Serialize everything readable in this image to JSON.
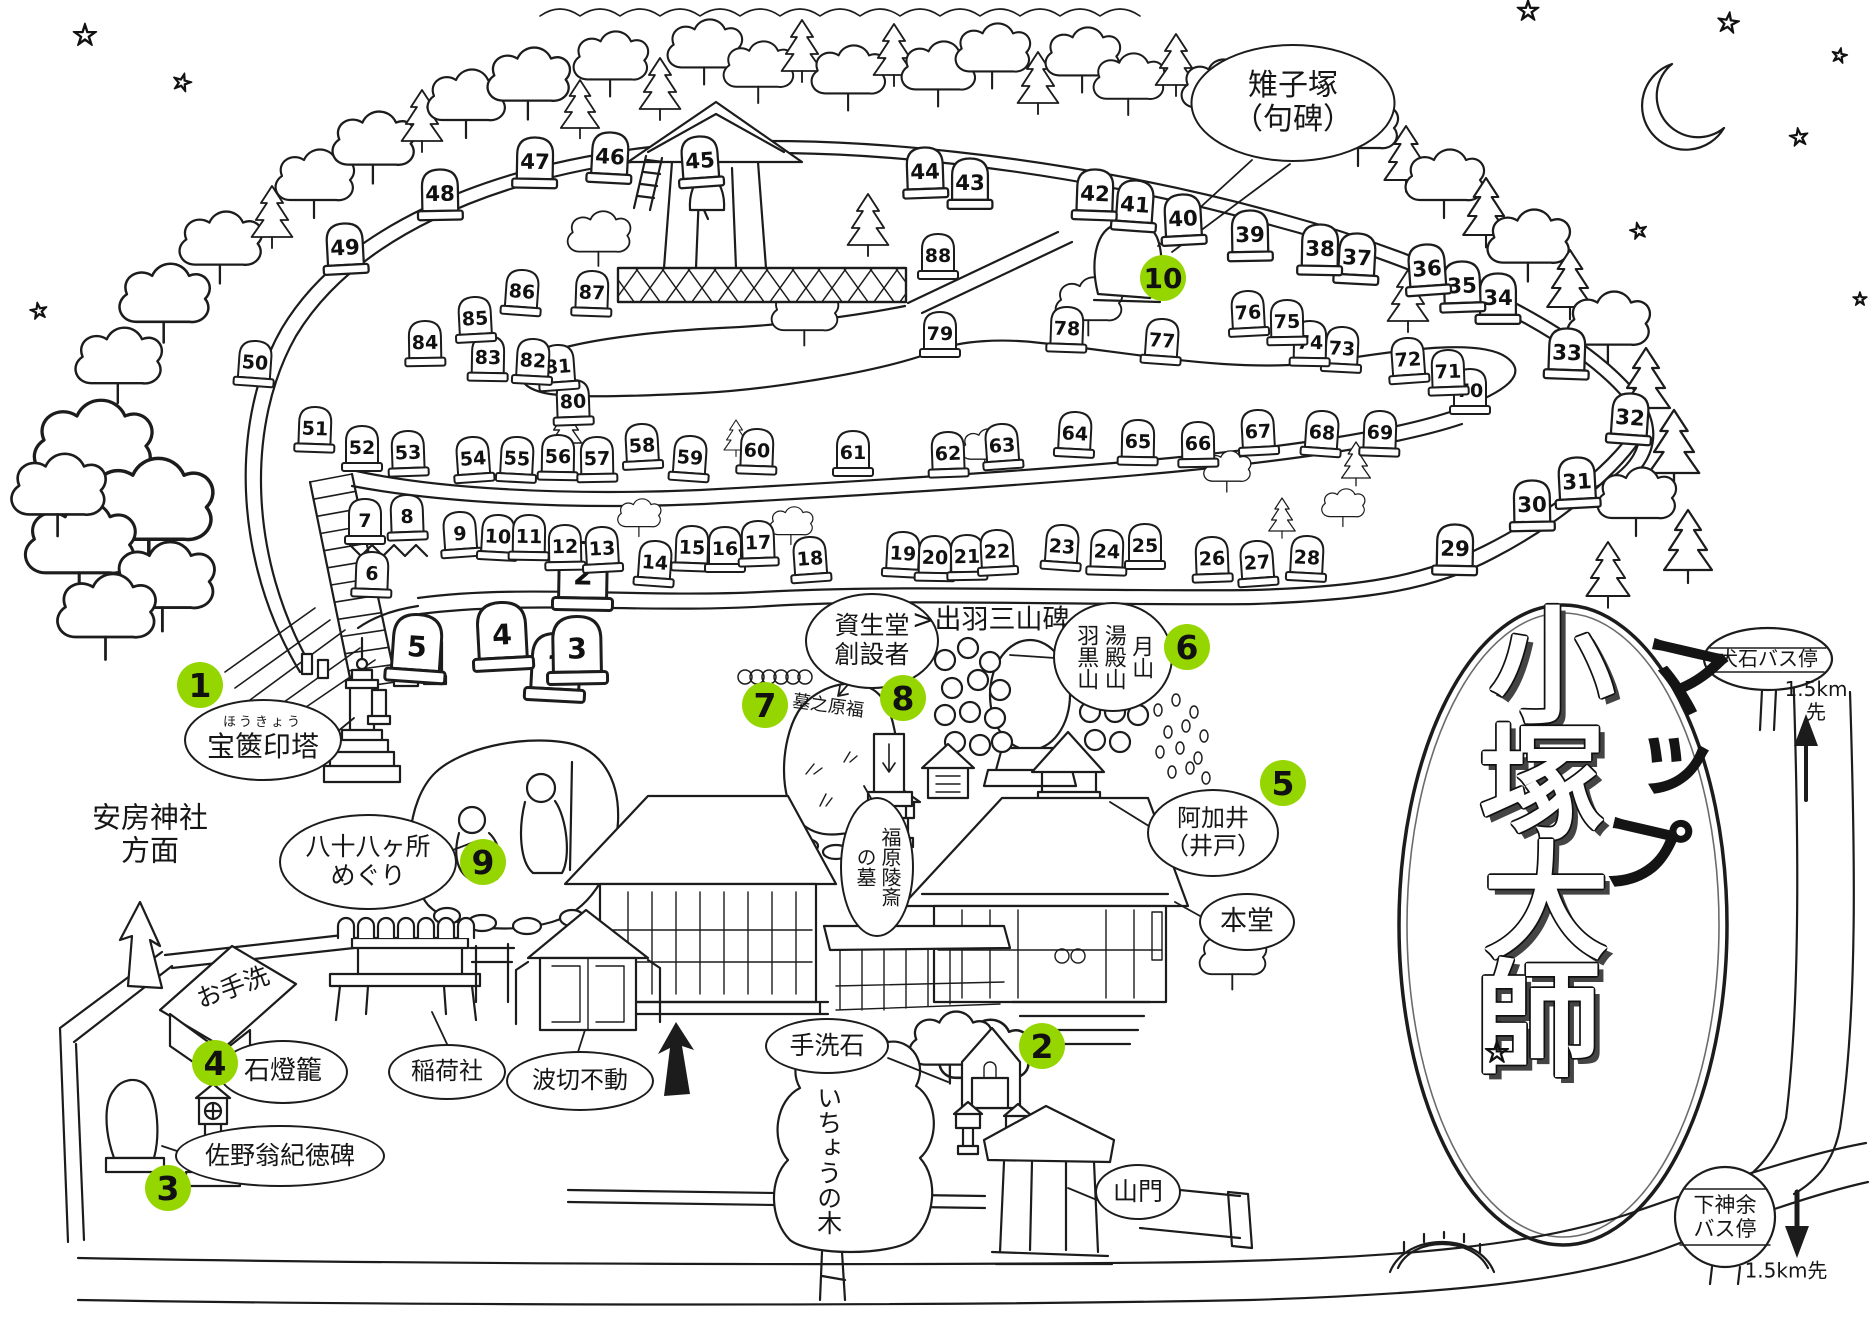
{
  "canvas": {
    "bg": "#ffffff",
    "ink": "#1c1c1c",
    "marker_green": "#96d600"
  },
  "title": {
    "chars": [
      "小",
      "塚",
      "大",
      "師"
    ],
    "sub": "マップ",
    "star": "☆"
  },
  "decorations": {
    "star_glyph": "☆"
  },
  "markers": [
    {
      "n": "1",
      "x": 200,
      "y": 685
    },
    {
      "n": "2",
      "x": 1042,
      "y": 1046
    },
    {
      "n": "3",
      "x": 168,
      "y": 1188
    },
    {
      "n": "4",
      "x": 215,
      "y": 1063
    },
    {
      "n": "5",
      "x": 1283,
      "y": 783
    },
    {
      "n": "6",
      "x": 1187,
      "y": 647
    },
    {
      "n": "7",
      "x": 765,
      "y": 705
    },
    {
      "n": "8",
      "x": 903,
      "y": 698
    },
    {
      "n": "9",
      "x": 483,
      "y": 862
    },
    {
      "n": "10",
      "x": 1163,
      "y": 278
    }
  ],
  "bubbles": [
    {
      "id": "kijizuka",
      "text": "雉子塚\n（句碑）",
      "x": 1293,
      "y": 103,
      "w": 205,
      "h": 118,
      "shape": "ellipse",
      "fs": 30
    },
    {
      "id": "hokyointo",
      "ruby": "ほうきょう",
      "text": "宝篋印塔",
      "x": 263,
      "y": 740,
      "w": 158,
      "h": 82,
      "shape": "ellipse",
      "fs": 28
    },
    {
      "id": "awa-jinja",
      "text": "安房神社\n方面",
      "x": 150,
      "y": 835,
      "shape": "plain",
      "fs": 29
    },
    {
      "id": "hachijuhachi",
      "text": "八十八ヶ所\nめぐり",
      "x": 368,
      "y": 862,
      "w": 178,
      "h": 96,
      "shape": "ellipse",
      "fs": 25
    },
    {
      "id": "otearai",
      "text": "お手洗",
      "x": 233,
      "y": 988,
      "shape": "plain",
      "fs": 25,
      "rot": -20
    },
    {
      "id": "ishidoro",
      "text": "石燈籠",
      "x": 283,
      "y": 1072,
      "w": 130,
      "h": 64,
      "shape": "ellipse",
      "fs": 26
    },
    {
      "id": "sano",
      "text": "佐野翁紀徳碑",
      "x": 280,
      "y": 1156,
      "w": 210,
      "h": 62,
      "shape": "ellipse",
      "fs": 25
    },
    {
      "id": "inari",
      "text": "稲荷社",
      "x": 447,
      "y": 1072,
      "w": 118,
      "h": 56,
      "shape": "ellipse",
      "fs": 24
    },
    {
      "id": "namikiri",
      "text": "波切不動",
      "x": 580,
      "y": 1081,
      "w": 148,
      "h": 60,
      "shape": "ellipse",
      "fs": 24
    },
    {
      "id": "shiseido",
      "text": "資生堂\n創設者",
      "x": 872,
      "y": 641,
      "w": 134,
      "h": 96,
      "shape": "ellipse",
      "fs": 25
    },
    {
      "id": "dewa",
      "text": ">出羽三山碑<",
      "x": 1002,
      "y": 620,
      "shape": "plain",
      "fs": 27
    },
    {
      "id": "sanzan",
      "text": "月山\n湯殿山\n羽黒山",
      "x": 1113,
      "y": 657,
      "w": 120,
      "h": 110,
      "shape": "ellipse",
      "fs": 22,
      "vertical": true
    },
    {
      "id": "fukuhara-grave",
      "text": "福原陵斎\nの墓",
      "x": 877,
      "y": 867,
      "w": 74,
      "h": 140,
      "shape": "ellipse",
      "fs": 20,
      "vertical": true
    },
    {
      "id": "fukuhara-rock",
      "text": "墓之原福",
      "x": 828,
      "y": 707,
      "shape": "plain",
      "fs": 18,
      "rot": 8
    },
    {
      "id": "akai",
      "text": "阿加井\n（井戸）",
      "x": 1213,
      "y": 833,
      "w": 132,
      "h": 88,
      "shape": "ellipse",
      "fs": 24
    },
    {
      "id": "hondo",
      "text": "本堂",
      "x": 1247,
      "y": 922,
      "w": 96,
      "h": 58,
      "shape": "ellipse",
      "fs": 27
    },
    {
      "id": "tearaiishi",
      "text": "手洗石",
      "x": 827,
      "y": 1046,
      "w": 124,
      "h": 56,
      "shape": "ellipse",
      "fs": 25
    },
    {
      "id": "icho",
      "text": "いちょうの木",
      "x": 828,
      "y": 1160,
      "shape": "plain",
      "fs": 25,
      "vertical": true
    },
    {
      "id": "sanmon",
      "text": "山門",
      "x": 1138,
      "y": 1192,
      "w": 86,
      "h": 56,
      "shape": "ellipse",
      "fs": 25
    },
    {
      "id": "inuishi-bus",
      "text": "犬石バス停",
      "x": 1768,
      "y": 659,
      "shape": "sign",
      "fs": 20
    },
    {
      "id": "inuishi-km",
      "text": "1.5km先",
      "x": 1816,
      "y": 701,
      "shape": "plain",
      "fs": 20
    },
    {
      "id": "shimokanamari-bus",
      "text": "下神余\nバス停",
      "x": 1725,
      "y": 1217,
      "shape": "sign",
      "fs": 21
    },
    {
      "id": "shimokanamari-km",
      "text": "1.5km先",
      "x": 1786,
      "y": 1271,
      "shape": "plain",
      "fs": 20
    }
  ],
  "stones": [
    {
      "n": 1,
      "x": 556,
      "y": 665
    },
    {
      "n": 2,
      "x": 583,
      "y": 574
    },
    {
      "n": 3,
      "x": 577,
      "y": 648
    },
    {
      "n": 4,
      "x": 502,
      "y": 634
    },
    {
      "n": 5,
      "x": 417,
      "y": 646
    },
    {
      "n": 6,
      "x": 372,
      "y": 573
    },
    {
      "n": 7,
      "x": 365,
      "y": 520
    },
    {
      "n": 8,
      "x": 407,
      "y": 516
    },
    {
      "n": 9,
      "x": 460,
      "y": 533
    },
    {
      "n": 10,
      "x": 498,
      "y": 536
    },
    {
      "n": 11,
      "x": 529,
      "y": 536
    },
    {
      "n": 12,
      "x": 565,
      "y": 546
    },
    {
      "n": 13,
      "x": 602,
      "y": 548
    },
    {
      "n": 14,
      "x": 655,
      "y": 562
    },
    {
      "n": 15,
      "x": 692,
      "y": 547
    },
    {
      "n": 16,
      "x": 725,
      "y": 548
    },
    {
      "n": 17,
      "x": 758,
      "y": 542
    },
    {
      "n": 18,
      "x": 810,
      "y": 558
    },
    {
      "n": 19,
      "x": 903,
      "y": 553
    },
    {
      "n": 20,
      "x": 935,
      "y": 557
    },
    {
      "n": 21,
      "x": 967,
      "y": 556
    },
    {
      "n": 22,
      "x": 997,
      "y": 551
    },
    {
      "n": 23,
      "x": 1062,
      "y": 546
    },
    {
      "n": 24,
      "x": 1107,
      "y": 551
    },
    {
      "n": 25,
      "x": 1145,
      "y": 545
    },
    {
      "n": 26,
      "x": 1212,
      "y": 558
    },
    {
      "n": 27,
      "x": 1257,
      "y": 562
    },
    {
      "n": 28,
      "x": 1307,
      "y": 557
    },
    {
      "n": 29,
      "x": 1455,
      "y": 548
    },
    {
      "n": 30,
      "x": 1532,
      "y": 504
    },
    {
      "n": 31,
      "x": 1577,
      "y": 481
    },
    {
      "n": 32,
      "x": 1630,
      "y": 417
    },
    {
      "n": 33,
      "x": 1567,
      "y": 352
    },
    {
      "n": 34,
      "x": 1498,
      "y": 297
    },
    {
      "n": 35,
      "x": 1462,
      "y": 285
    },
    {
      "n": 36,
      "x": 1427,
      "y": 268
    },
    {
      "n": 37,
      "x": 1357,
      "y": 257
    },
    {
      "n": 38,
      "x": 1320,
      "y": 248
    },
    {
      "n": 39,
      "x": 1250,
      "y": 234
    },
    {
      "n": 40,
      "x": 1183,
      "y": 218
    },
    {
      "n": 41,
      "x": 1135,
      "y": 204
    },
    {
      "n": 42,
      "x": 1095,
      "y": 193
    },
    {
      "n": 43,
      "x": 970,
      "y": 182
    },
    {
      "n": 44,
      "x": 925,
      "y": 171
    },
    {
      "n": 45,
      "x": 700,
      "y": 160
    },
    {
      "n": 46,
      "x": 610,
      "y": 156
    },
    {
      "n": 47,
      "x": 535,
      "y": 161
    },
    {
      "n": 48,
      "x": 440,
      "y": 193
    },
    {
      "n": 49,
      "x": 345,
      "y": 247
    },
    {
      "n": 50,
      "x": 255,
      "y": 362
    },
    {
      "n": 51,
      "x": 315,
      "y": 428
    },
    {
      "n": 52,
      "x": 362,
      "y": 447
    },
    {
      "n": 53,
      "x": 408,
      "y": 452
    },
    {
      "n": 54,
      "x": 473,
      "y": 458
    },
    {
      "n": 55,
      "x": 517,
      "y": 458
    },
    {
      "n": 56,
      "x": 558,
      "y": 456
    },
    {
      "n": 57,
      "x": 597,
      "y": 458
    },
    {
      "n": 58,
      "x": 642,
      "y": 445
    },
    {
      "n": 59,
      "x": 690,
      "y": 457
    },
    {
      "n": 60,
      "x": 757,
      "y": 450
    },
    {
      "n": 61,
      "x": 853,
      "y": 452
    },
    {
      "n": 62,
      "x": 948,
      "y": 453
    },
    {
      "n": 63,
      "x": 1002,
      "y": 445
    },
    {
      "n": 64,
      "x": 1075,
      "y": 433
    },
    {
      "n": 65,
      "x": 1138,
      "y": 441
    },
    {
      "n": 66,
      "x": 1198,
      "y": 443
    },
    {
      "n": 67,
      "x": 1258,
      "y": 431
    },
    {
      "n": 68,
      "x": 1322,
      "y": 432
    },
    {
      "n": 69,
      "x": 1380,
      "y": 432
    },
    {
      "n": 70,
      "x": 1470,
      "y": 390
    },
    {
      "n": 71,
      "x": 1448,
      "y": 371
    },
    {
      "n": 72,
      "x": 1408,
      "y": 359
    },
    {
      "n": 73,
      "x": 1342,
      "y": 348
    },
    {
      "n": 74,
      "x": 1310,
      "y": 342
    },
    {
      "n": 75,
      "x": 1287,
      "y": 321
    },
    {
      "n": 76,
      "x": 1248,
      "y": 312
    },
    {
      "n": 77,
      "x": 1162,
      "y": 340
    },
    {
      "n": 78,
      "x": 1067,
      "y": 328
    },
    {
      "n": 79,
      "x": 940,
      "y": 333
    },
    {
      "n": 80,
      "x": 573,
      "y": 401
    },
    {
      "n": 81,
      "x": 558,
      "y": 366
    },
    {
      "n": 82,
      "x": 533,
      "y": 360
    },
    {
      "n": 83,
      "x": 488,
      "y": 357
    },
    {
      "n": 84,
      "x": 425,
      "y": 342
    },
    {
      "n": 85,
      "x": 475,
      "y": 318
    },
    {
      "n": 86,
      "x": 522,
      "y": 291
    },
    {
      "n": 87,
      "x": 592,
      "y": 292
    },
    {
      "n": 88,
      "x": 938,
      "y": 255
    }
  ]
}
